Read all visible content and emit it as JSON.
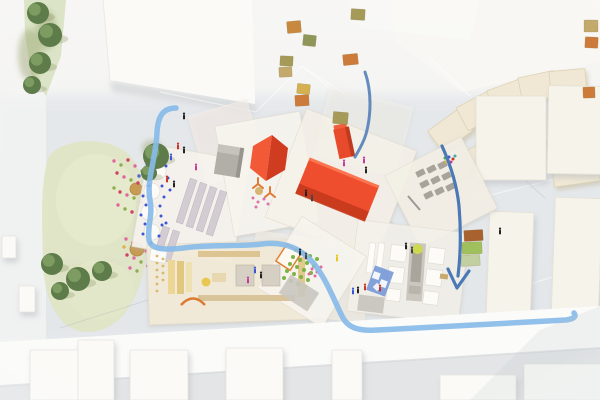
{
  "scene": {
    "kind": "photograph",
    "subject": "top-down aerial view of an architectural scale model",
    "board": "site model with painted blue river and arrows, red roofed pavilions, overlapping paper floor plans, green park with trees, tiny human figures, wooden context blocks"
  },
  "palette": {
    "background_top": "#f7f6f4",
    "background_bottom": "#edeff0",
    "board_gray": "#dde2e7",
    "band_white": "#fbfbf9",
    "table_gray": "#e3e5e6",
    "park_green": "#dfe4c4",
    "strip_green": "#dbe4c6",
    "tree_green": "#5d7c49",
    "paper_white": "#f7f4ee",
    "paper_beige": "#f2ead8",
    "red_roof": "#cf3c20",
    "red_roof_light": "#f25936",
    "red_box": "#ee4e2d",
    "red_box_dark": "#c53a1d",
    "gray_roof": "#b2afa9",
    "river_blue": "#88bbe8",
    "ink_blue": "#4a79b5",
    "cream_block": "#f0e8d4",
    "white_block": "#fbfaf7",
    "tower_cream": "#f6f3ea",
    "stall_mauve": "#d3ccd3",
    "furniture_tan": "#dcc593",
    "garden_green": "#7cb347",
    "orange_accent": "#e0812f",
    "blue_panel": "#6e93d6"
  },
  "dots": {
    "flowers": [
      [
        114,
        161,
        "#e0689f"
      ],
      [
        121,
        165,
        "#8fae4f"
      ],
      [
        128,
        160,
        "#cf4364"
      ],
      [
        135,
        166,
        "#e0689f"
      ],
      [
        142,
        171,
        "#8fae4f"
      ],
      [
        117,
        173,
        "#cf4364"
      ],
      [
        124,
        177,
        "#e0689f"
      ],
      [
        131,
        180,
        "#8fae4f"
      ],
      [
        138,
        183,
        "#cf4364"
      ],
      [
        145,
        186,
        "#e0689f"
      ],
      [
        114,
        188,
        "#8fae4f"
      ],
      [
        120,
        192,
        "#cf4364"
      ],
      [
        127,
        195,
        "#e0689f"
      ],
      [
        134,
        198,
        "#8fae4f"
      ],
      [
        141,
        202,
        "#cf4364"
      ],
      [
        118,
        205,
        "#e0689f"
      ],
      [
        125,
        209,
        "#8fae4f"
      ],
      [
        132,
        212,
        "#cf4364"
      ],
      [
        146,
        194,
        "#ddb347"
      ],
      [
        139,
        176,
        "#5566cc"
      ],
      [
        126,
        239,
        "#e0689f"
      ],
      [
        133,
        243,
        "#cf4364"
      ],
      [
        140,
        247,
        "#8fae4f"
      ],
      [
        146,
        251,
        "#e0689f"
      ],
      [
        127,
        255,
        "#cf4364"
      ],
      [
        134,
        258,
        "#e0689f"
      ],
      [
        141,
        262,
        "#8fae4f"
      ],
      [
        148,
        266,
        "#cf4364"
      ],
      [
        130,
        268,
        "#e0689f"
      ],
      [
        137,
        271,
        "#8fae4f"
      ],
      [
        124,
        247,
        "#ddb347"
      ]
    ],
    "blue": [
      [
        147,
        164
      ],
      [
        157,
        161
      ],
      [
        166,
        166
      ],
      [
        145,
        177
      ],
      [
        168,
        178
      ],
      [
        149,
        186
      ],
      [
        162,
        186
      ],
      [
        143,
        196
      ],
      [
        164,
        197
      ],
      [
        146,
        205
      ],
      [
        160,
        206
      ],
      [
        141,
        215
      ],
      [
        161,
        216
      ],
      [
        145,
        224
      ],
      [
        162,
        225
      ],
      [
        143,
        234
      ],
      [
        159,
        236
      ],
      [
        151,
        243
      ],
      [
        170,
        190
      ],
      [
        166,
        223
      ]
    ],
    "garden": [
      [
        296,
        250
      ],
      [
        303,
        253
      ],
      [
        310,
        256
      ],
      [
        317,
        259
      ],
      [
        293,
        257
      ],
      [
        300,
        260
      ],
      [
        307,
        263
      ],
      [
        314,
        266
      ],
      [
        290,
        264
      ],
      [
        297,
        267
      ],
      [
        304,
        270
      ],
      [
        311,
        273
      ],
      [
        287,
        271
      ],
      [
        294,
        274
      ],
      [
        301,
        277
      ],
      [
        308,
        280
      ],
      [
        284,
        278
      ],
      [
        291,
        281
      ],
      [
        298,
        284
      ],
      [
        305,
        287,
        "#ddb347"
      ]
    ],
    "pink_e": [
      [
        312,
        269
      ],
      [
        317,
        272
      ],
      [
        321,
        267
      ],
      [
        315,
        276
      ],
      [
        309,
        274
      ]
    ],
    "pink_hex": [
      [
        253,
        198
      ],
      [
        258,
        202
      ],
      [
        264,
        199
      ],
      [
        268,
        204
      ],
      [
        256,
        207
      ]
    ],
    "plan_specks": [
      [
        157,
        256
      ],
      [
        157,
        263
      ],
      [
        157,
        270
      ],
      [
        157,
        277
      ],
      [
        157,
        284
      ],
      [
        157,
        291
      ],
      [
        163,
        259
      ],
      [
        163,
        266
      ],
      [
        163,
        273
      ],
      [
        163,
        280
      ]
    ],
    "f_pixels": [
      [
        445,
        158,
        "#44aa44"
      ],
      [
        449,
        157,
        "#3b55d4"
      ],
      [
        453,
        159,
        "#cc3322"
      ],
      [
        446,
        162,
        "#ddb347"
      ],
      [
        451,
        162,
        "#c43a9a"
      ],
      [
        455,
        156,
        "#44aaaa"
      ]
    ]
  },
  "figures": [
    [
      178,
      146,
      "#cc3322"
    ],
    [
      184,
      150,
      "#222222"
    ],
    [
      171,
      157,
      "#3b55d4"
    ],
    [
      167,
      179,
      "#cc3322"
    ],
    [
      174,
      184,
      "#222222"
    ],
    [
      196,
      167,
      "#c43a9a"
    ],
    [
      184,
      116,
      "#222222"
    ],
    [
      306,
      193,
      "#222222"
    ],
    [
      312,
      198,
      "#444444"
    ],
    [
      300,
      252,
      "#222222"
    ],
    [
      306,
      256,
      "#444444"
    ],
    [
      255,
      270,
      "#3b55d4"
    ],
    [
      261,
      275,
      "#222222"
    ],
    [
      248,
      280,
      "#c43a9a"
    ],
    [
      337,
      258,
      "#e8c61e"
    ],
    [
      353,
      291,
      "#3b55d4"
    ],
    [
      358,
      290,
      "#222222"
    ],
    [
      365,
      287,
      "#cc3322"
    ],
    [
      406,
      246,
      "#222222"
    ],
    [
      412,
      250,
      "#444444"
    ],
    [
      364,
      160,
      "#c43a9a"
    ],
    [
      366,
      170,
      "#222222"
    ],
    [
      344,
      163,
      "#c43a9a"
    ],
    [
      500,
      231,
      "#222222"
    ],
    [
      380,
      288,
      "#cc3322"
    ]
  ],
  "blocks": {
    "context": [
      [
        287,
        21,
        14,
        12,
        -5,
        "#c8883f"
      ],
      [
        303,
        35,
        13,
        11,
        6,
        "#8f9659"
      ],
      [
        280,
        56,
        13,
        10,
        3,
        "#a59a58"
      ],
      [
        279,
        67,
        13,
        10,
        -3,
        "#c3a96c"
      ],
      [
        297,
        84,
        13,
        10,
        6,
        "#d4b050"
      ],
      [
        295,
        95,
        14,
        11,
        -3,
        "#cd7b3a"
      ],
      [
        351,
        9,
        14,
        11,
        3,
        "#a59a58"
      ],
      [
        343,
        54,
        15,
        11,
        -6,
        "#cd7b3a"
      ],
      [
        333,
        112,
        15,
        12,
        5,
        "#a59a58"
      ],
      [
        584,
        20,
        14,
        12,
        0,
        "#c3a96c"
      ],
      [
        585,
        37,
        13,
        11,
        3,
        "#cd7b3a"
      ],
      [
        583,
        87,
        12,
        11,
        -2,
        "#cd7b3a"
      ],
      [
        464,
        230,
        19,
        11,
        -3,
        "#a8622f"
      ],
      [
        462,
        242,
        20,
        12,
        -2,
        "#9fc05c"
      ],
      [
        461,
        255,
        19,
        11,
        -3,
        "#c2cfa0"
      ]
    ],
    "cream": [
      [
        432,
        118,
        36,
        26,
        -36
      ],
      [
        460,
        98,
        36,
        26,
        -28
      ],
      [
        490,
        84,
        36,
        26,
        -20
      ],
      [
        520,
        74,
        36,
        26,
        -12
      ],
      [
        550,
        70,
        36,
        26,
        -5
      ],
      [
        468,
        142,
        34,
        24,
        -30
      ],
      [
        498,
        128,
        34,
        24,
        -20
      ],
      [
        528,
        118,
        34,
        24,
        -12
      ],
      [
        558,
        112,
        36,
        26,
        -5
      ],
      [
        552,
        148,
        46,
        36,
        -8
      ],
      [
        586,
        96,
        30,
        46,
        2
      ],
      [
        440,
        160,
        28,
        20,
        -34
      ]
    ],
    "towers": [
      [
        476,
        96,
        70,
        84,
        0
      ],
      [
        548,
        86,
        54,
        88,
        1
      ],
      [
        488,
        212,
        44,
        106,
        2
      ],
      [
        553,
        198,
        47,
        136,
        2
      ]
    ],
    "bottom": [
      [
        30,
        350,
        48,
        50,
        0
      ],
      [
        78,
        340,
        36,
        60,
        0
      ],
      [
        130,
        350,
        58,
        50,
        0
      ],
      [
        226,
        348,
        57,
        52,
        0
      ],
      [
        332,
        350,
        30,
        50,
        0
      ],
      [
        440,
        375,
        76,
        25,
        0
      ],
      [
        524,
        364,
        78,
        36,
        0
      ],
      [
        2,
        236,
        14,
        22,
        0
      ],
      [
        19,
        286,
        16,
        26,
        0
      ]
    ],
    "f_units": [
      [
        416,
        170,
        9,
        6,
        -27
      ],
      [
        427,
        166,
        9,
        6,
        -27
      ],
      [
        438,
        162,
        9,
        6,
        -27
      ],
      [
        420,
        181,
        9,
        6,
        -27
      ],
      [
        431,
        177,
        9,
        6,
        -27
      ],
      [
        442,
        173,
        9,
        6,
        -27
      ],
      [
        424,
        192,
        9,
        6,
        -27
      ],
      [
        435,
        188,
        9,
        6,
        -27
      ],
      [
        446,
        184,
        9,
        6,
        -27
      ]
    ]
  },
  "trees": {
    "strip": [
      [
        38,
        13,
        11
      ],
      [
        50,
        35,
        12
      ],
      [
        40,
        63,
        11
      ],
      [
        32,
        85,
        9
      ]
    ],
    "park": [
      [
        52,
        264,
        11
      ],
      [
        78,
        279,
        12
      ],
      [
        102,
        271,
        10
      ],
      [
        60,
        291,
        9
      ]
    ],
    "center": [
      [
        156,
        156,
        13
      ],
      [
        149,
        173,
        8
      ]
    ]
  },
  "smudges": [
    [
      30,
      55,
      12,
      26
    ],
    [
      46,
      30,
      10,
      20
    ],
    [
      74,
      272,
      26,
      10
    ],
    [
      108,
      266,
      14,
      7
    ],
    [
      322,
      133,
      9,
      7
    ],
    [
      152,
      148,
      10,
      8
    ]
  ]
}
